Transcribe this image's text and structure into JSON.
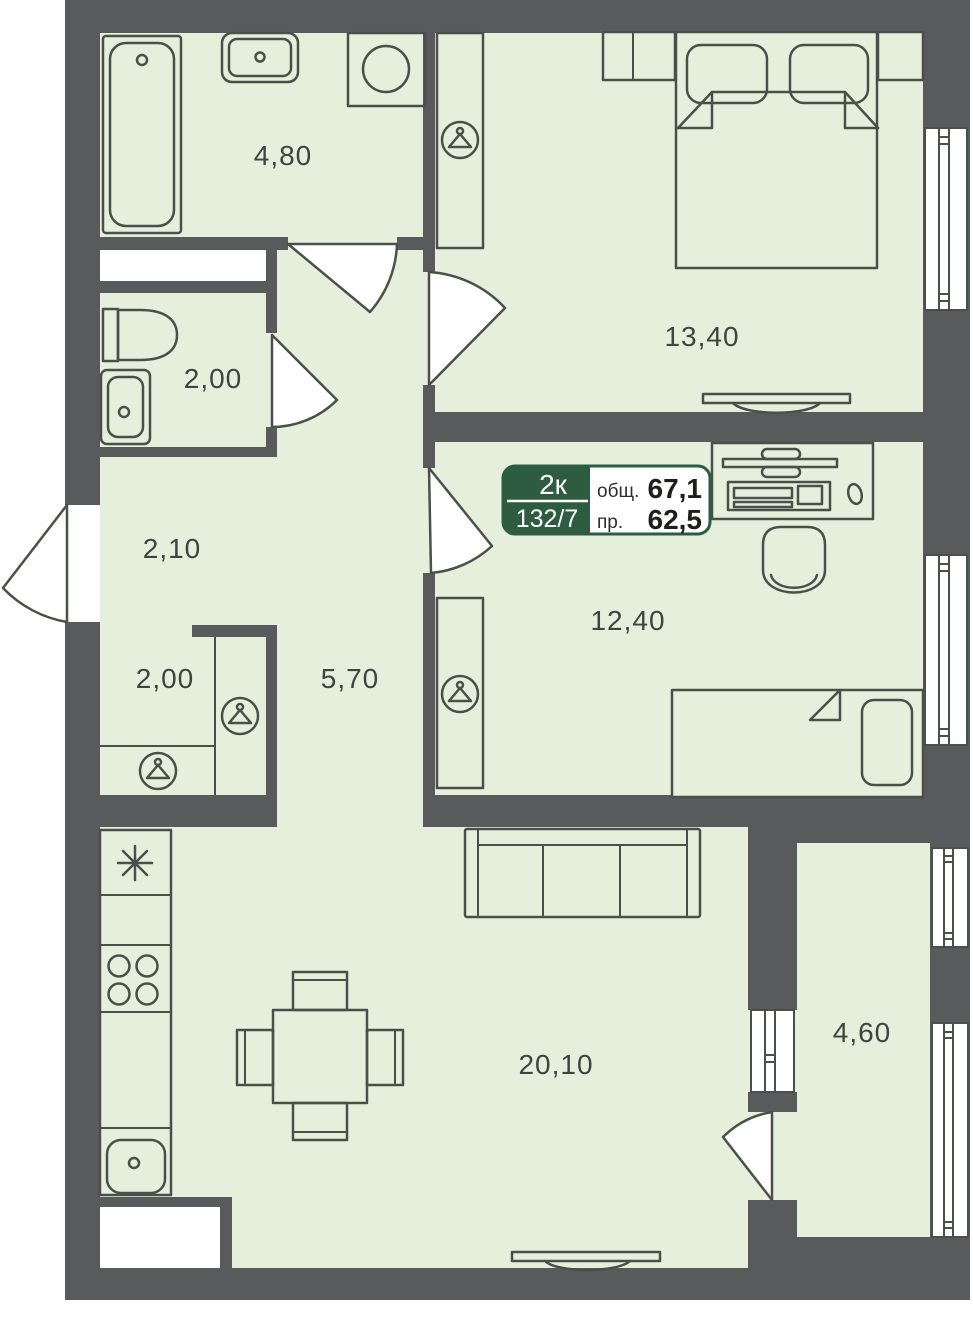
{
  "plan": {
    "type": "apartment-floor-plan",
    "badge": {
      "rooms_count": "2к",
      "unit_number": "132/7",
      "total_area_label": "общ.",
      "total_area_value": "67,1",
      "living_area_label": "пр.",
      "living_area_value": "62,5"
    },
    "areas": {
      "bathroom": "4,80",
      "toilet": "2,00",
      "hall": "2,10",
      "wardrobe": "2,00",
      "corridor": "5,70",
      "bedroom": "13,40",
      "child_room": "12,40",
      "kitchen_living": "20,10",
      "balcony": "4,60"
    },
    "colors": {
      "floor": "#e5efdc",
      "wall": "#595a5c",
      "furniture_outline": "#49504a",
      "badge_green": "#2d5c40",
      "label_text": "#3e443e",
      "background": "#ffffff"
    },
    "icons": {
      "wardrobe_icon": "hanger-icon",
      "fridge_icon": "asterisk-snowflake-icon"
    }
  }
}
